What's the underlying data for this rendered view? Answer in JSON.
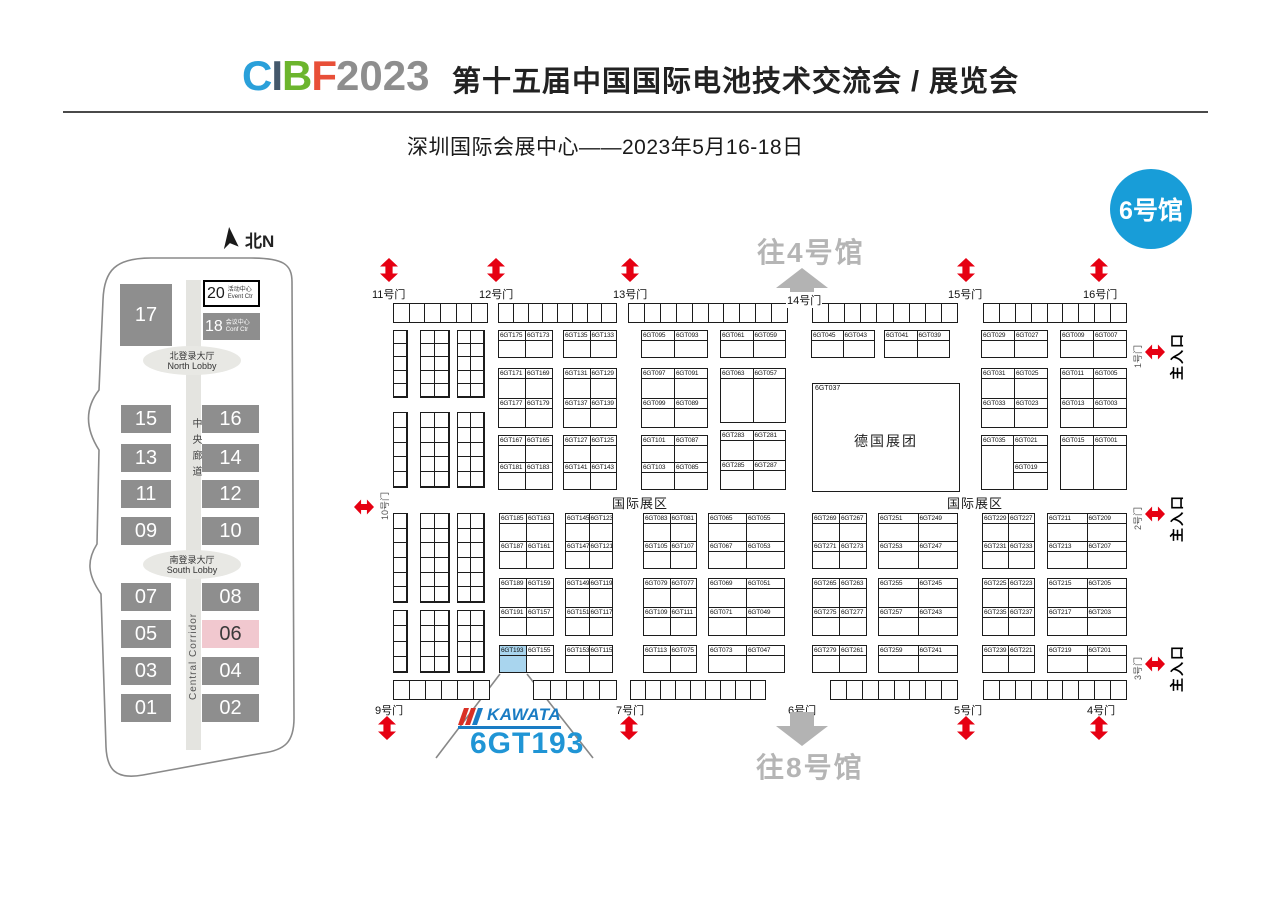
{
  "header": {
    "logo": {
      "letters": [
        {
          "ch": "C",
          "color": "#2aa0da"
        },
        {
          "ch": "I",
          "color": "#44586b"
        },
        {
          "ch": "B",
          "color": "#6cb52d"
        },
        {
          "ch": "F",
          "color": "#e84f38"
        }
      ],
      "year": "2023",
      "year_color": "#8e8e8e"
    },
    "title": "第十五届中国国际电池技术交流会 / 展览会",
    "subtitle": "深圳国际会展中心——2023年5月16-18日"
  },
  "hall_badge": {
    "label": "6号馆",
    "color": "#189dd8"
  },
  "minimap": {
    "north_label": "北N",
    "hall17": "17",
    "hall20": {
      "num": "20",
      "cn": "活动中心",
      "en": "Event Ctr"
    },
    "hall18": {
      "num": "18",
      "cn": "会议中心",
      "en": "Conf Ctr"
    },
    "north_lobby": {
      "cn": "北登录大厅",
      "en": "North Lobby"
    },
    "south_lobby": {
      "cn": "南登录大厅",
      "en": "South Lobby"
    },
    "corridor_cn": "中央廊道",
    "corridor_en": "Central Corridor",
    "rows": [
      [
        "15",
        "16"
      ],
      [
        "13",
        "14"
      ],
      [
        "11",
        "12"
      ],
      [
        "09",
        "10"
      ],
      [
        "07",
        "08"
      ],
      [
        "05",
        "06"
      ],
      [
        "03",
        "04"
      ],
      [
        "01",
        "02"
      ]
    ],
    "row_y": [
      183,
      222,
      258,
      295,
      361,
      398,
      435,
      472
    ],
    "highlighted_hall": "06"
  },
  "map": {
    "to_hall4": "往4号馆",
    "to_hall8": "往8号馆",
    "intl_zone": "国际展区",
    "main_entrance": "主入口",
    "left_gate": "10号门",
    "gate14": "14号门",
    "gate6": "6号门",
    "german_pavilion": {
      "booth": "6GT037",
      "name": "德国展团"
    },
    "kawata_logo": "KAWATA",
    "callout_booth": "6GT193",
    "highlight_booth": "6GT193",
    "gates_top": [
      {
        "label": "11号门",
        "label_x": 371,
        "arrow_x": 379
      },
      {
        "label": "12号门",
        "label_x": 478,
        "arrow_x": 486
      },
      {
        "label": "13号门",
        "label_x": 612,
        "arrow_x": 620
      },
      {
        "label": "15号门",
        "label_x": 947,
        "arrow_x": 956
      },
      {
        "label": "16号门",
        "label_x": 1082,
        "arrow_x": 1089
      }
    ],
    "gates_bottom": [
      {
        "label": "9号门",
        "label_x": 374,
        "arrow_x": 377
      },
      {
        "label": "7号门",
        "label_x": 615,
        "arrow_x": 619
      },
      {
        "label": "5号门",
        "label_x": 953,
        "arrow_x": 956
      },
      {
        "label": "4号门",
        "label_x": 1086,
        "arrow_x": 1089
      }
    ],
    "side_gates": [
      {
        "door": "1号门",
        "y": 336
      },
      {
        "door": "2号门",
        "y": 498
      },
      {
        "door": "3号门",
        "y": 648
      }
    ],
    "strips": [
      {
        "x": 393,
        "y": 303,
        "w": 95,
        "h": 20,
        "cells": 6
      },
      {
        "x": 498,
        "y": 303,
        "w": 119,
        "h": 20,
        "cells": 8
      },
      {
        "x": 628,
        "y": 303,
        "w": 160,
        "h": 20,
        "cells": 10
      },
      {
        "x": 812,
        "y": 303,
        "w": 146,
        "h": 20,
        "cells": 9
      },
      {
        "x": 983,
        "y": 303,
        "w": 144,
        "h": 20,
        "cells": 9
      },
      {
        "x": 393,
        "y": 680,
        "w": 97,
        "h": 20,
        "cells": 6
      },
      {
        "x": 533,
        "y": 680,
        "w": 84,
        "h": 20,
        "cells": 5
      },
      {
        "x": 630,
        "y": 680,
        "w": 136,
        "h": 20,
        "cells": 9
      },
      {
        "x": 830,
        "y": 680,
        "w": 128,
        "h": 20,
        "cells": 8
      },
      {
        "x": 983,
        "y": 680,
        "w": 144,
        "h": 20,
        "cells": 9
      }
    ],
    "small_groups": [
      {
        "x": 393,
        "y": 330,
        "w": 15,
        "h": 68,
        "cols": 1,
        "rows": 5
      },
      {
        "x": 420,
        "y": 330,
        "w": 30,
        "h": 68,
        "cols": 2,
        "rows": 5
      },
      {
        "x": 457,
        "y": 330,
        "w": 28,
        "h": 68,
        "cols": 2,
        "rows": 5
      },
      {
        "x": 393,
        "y": 412,
        "w": 15,
        "h": 76,
        "cols": 1,
        "rows": 5
      },
      {
        "x": 420,
        "y": 412,
        "w": 30,
        "h": 76,
        "cols": 2,
        "rows": 5
      },
      {
        "x": 457,
        "y": 412,
        "w": 28,
        "h": 76,
        "cols": 2,
        "rows": 5
      },
      {
        "x": 393,
        "y": 513,
        "w": 15,
        "h": 90,
        "cols": 1,
        "rows": 6
      },
      {
        "x": 420,
        "y": 513,
        "w": 30,
        "h": 90,
        "cols": 2,
        "rows": 6
      },
      {
        "x": 457,
        "y": 513,
        "w": 28,
        "h": 90,
        "cols": 2,
        "rows": 6
      },
      {
        "x": 393,
        "y": 610,
        "w": 15,
        "h": 63,
        "cols": 1,
        "rows": 4
      },
      {
        "x": 420,
        "y": 610,
        "w": 30,
        "h": 63,
        "cols": 2,
        "rows": 4
      },
      {
        "x": 457,
        "y": 610,
        "w": 28,
        "h": 63,
        "cols": 2,
        "rows": 4
      }
    ],
    "blocks": [
      {
        "x": 498,
        "y": 330,
        "w": 55,
        "h": 28,
        "rows": [
          [
            "6GT175",
            "6GT173"
          ]
        ]
      },
      {
        "x": 563,
        "y": 330,
        "w": 54,
        "h": 28,
        "rows": [
          [
            "6GT135",
            "6GT133"
          ]
        ]
      },
      {
        "x": 641,
        "y": 330,
        "w": 67,
        "h": 28,
        "rows": [
          [
            "6GT095",
            "6GT093"
          ]
        ]
      },
      {
        "x": 720,
        "y": 330,
        "w": 66,
        "h": 28,
        "rows": [
          [
            "6GT061",
            "6GT059"
          ]
        ]
      },
      {
        "x": 811,
        "y": 330,
        "w": 64,
        "h": 28,
        "rows": [
          [
            "6GT045",
            "6GT043"
          ]
        ]
      },
      {
        "x": 884,
        "y": 330,
        "w": 66,
        "h": 28,
        "rows": [
          [
            "6GT041",
            "6GT039"
          ]
        ]
      },
      {
        "x": 981,
        "y": 330,
        "w": 67,
        "h": 28,
        "rows": [
          [
            "6GT029",
            "6GT027"
          ]
        ]
      },
      {
        "x": 1060,
        "y": 330,
        "w": 67,
        "h": 28,
        "rows": [
          [
            "6GT009",
            "6GT007"
          ]
        ]
      },
      {
        "x": 498,
        "y": 368,
        "w": 55,
        "h": 60,
        "rows": [
          [
            "6GT171",
            "6GT169"
          ],
          [
            "6GT177",
            "6GT179"
          ]
        ]
      },
      {
        "x": 563,
        "y": 368,
        "w": 54,
        "h": 60,
        "rows": [
          [
            "6GT131",
            "6GT129"
          ],
          [
            "6GT137",
            "6GT139"
          ]
        ]
      },
      {
        "x": 641,
        "y": 368,
        "w": 67,
        "h": 60,
        "rows": [
          [
            "6GT097",
            "6GT091"
          ],
          [
            "6GT099",
            "6GT089"
          ]
        ]
      },
      {
        "x": 720,
        "y": 368,
        "w": 66,
        "h": 55,
        "rows": [
          [
            "6GT063",
            "6GT057"
          ]
        ]
      },
      {
        "x": 981,
        "y": 368,
        "w": 67,
        "h": 60,
        "rows": [
          [
            "6GT031",
            "6GT025"
          ],
          [
            "6GT033",
            "6GT023"
          ]
        ]
      },
      {
        "x": 1060,
        "y": 368,
        "w": 67,
        "h": 60,
        "rows": [
          [
            "6GT011",
            "6GT005"
          ],
          [
            "6GT013",
            "6GT003"
          ]
        ]
      },
      {
        "x": 498,
        "y": 435,
        "w": 55,
        "h": 55,
        "rows": [
          [
            "6GT167",
            "6GT165"
          ],
          [
            "6GT181",
            "6GT183"
          ]
        ]
      },
      {
        "x": 563,
        "y": 435,
        "w": 54,
        "h": 55,
        "rows": [
          [
            "6GT127",
            "6GT125"
          ],
          [
            "6GT141",
            "6GT143"
          ]
        ]
      },
      {
        "x": 641,
        "y": 435,
        "w": 67,
        "h": 55,
        "rows": [
          [
            "6GT101",
            "6GT087"
          ],
          [
            "6GT103",
            "6GT085"
          ]
        ]
      },
      {
        "x": 720,
        "y": 430,
        "w": 66,
        "h": 60,
        "rows": [
          [
            "6GT283",
            "6GT281"
          ],
          [
            "6GT285",
            "6GT287"
          ]
        ]
      },
      {
        "x": 981,
        "y": 435,
        "w": 33,
        "h": 55,
        "rows": [
          [
            "6GT035"
          ]
        ]
      },
      {
        "x": 1013,
        "y": 435,
        "w": 35,
        "h": 55,
        "rows": [
          [
            "6GT021"
          ],
          [
            "6GT019"
          ]
        ]
      },
      {
        "x": 1060,
        "y": 435,
        "w": 67,
        "h": 55,
        "rows": [
          [
            "6GT015",
            "6GT001"
          ]
        ]
      },
      {
        "x": 499,
        "y": 513,
        "w": 55,
        "h": 56,
        "rows": [
          [
            "6GT185",
            "6GT163"
          ],
          [
            "6GT187",
            "6GT161"
          ]
        ]
      },
      {
        "x": 565,
        "y": 513,
        "w": 48,
        "h": 56,
        "rows": [
          [
            "6GT145",
            "6GT123"
          ],
          [
            "6GT147",
            "6GT121"
          ]
        ]
      },
      {
        "x": 643,
        "y": 513,
        "w": 54,
        "h": 56,
        "rows": [
          [
            "6GT083",
            "6GT081"
          ],
          [
            "6GT105",
            "6GT107"
          ]
        ]
      },
      {
        "x": 708,
        "y": 513,
        "w": 77,
        "h": 56,
        "rows": [
          [
            "6GT065",
            "6GT055"
          ],
          [
            "6GT067",
            "6GT053"
          ]
        ]
      },
      {
        "x": 812,
        "y": 513,
        "w": 55,
        "h": 56,
        "rows": [
          [
            "6GT269",
            "6GT267"
          ],
          [
            "6GT271",
            "6GT273"
          ]
        ]
      },
      {
        "x": 878,
        "y": 513,
        "w": 80,
        "h": 56,
        "rows": [
          [
            "6GT251",
            "6GT249"
          ],
          [
            "6GT253",
            "6GT247"
          ]
        ]
      },
      {
        "x": 982,
        "y": 513,
        "w": 53,
        "h": 56,
        "rows": [
          [
            "6GT229",
            "6GT227"
          ],
          [
            "6GT231",
            "6GT233"
          ]
        ]
      },
      {
        "x": 1047,
        "y": 513,
        "w": 80,
        "h": 56,
        "rows": [
          [
            "6GT211",
            "6GT209"
          ],
          [
            "6GT213",
            "6GT207"
          ]
        ]
      },
      {
        "x": 499,
        "y": 578,
        "w": 55,
        "h": 58,
        "rows": [
          [
            "6GT189",
            "6GT159"
          ],
          [
            "6GT191",
            "6GT157"
          ]
        ]
      },
      {
        "x": 565,
        "y": 578,
        "w": 48,
        "h": 58,
        "rows": [
          [
            "6GT149",
            "6GT119"
          ],
          [
            "6GT151",
            "6GT117"
          ]
        ]
      },
      {
        "x": 643,
        "y": 578,
        "w": 54,
        "h": 58,
        "rows": [
          [
            "6GT079",
            "6GT077"
          ],
          [
            "6GT109",
            "6GT111"
          ]
        ]
      },
      {
        "x": 708,
        "y": 578,
        "w": 77,
        "h": 58,
        "rows": [
          [
            "6GT069",
            "6GT051"
          ],
          [
            "6GT071",
            "6GT049"
          ]
        ]
      },
      {
        "x": 812,
        "y": 578,
        "w": 55,
        "h": 58,
        "rows": [
          [
            "6GT265",
            "6GT263"
          ],
          [
            "6GT275",
            "6GT277"
          ]
        ]
      },
      {
        "x": 878,
        "y": 578,
        "w": 80,
        "h": 58,
        "rows": [
          [
            "6GT255",
            "6GT245"
          ],
          [
            "6GT257",
            "6GT243"
          ]
        ]
      },
      {
        "x": 982,
        "y": 578,
        "w": 53,
        "h": 58,
        "rows": [
          [
            "6GT225",
            "6GT223"
          ],
          [
            "6GT235",
            "6GT237"
          ]
        ]
      },
      {
        "x": 1047,
        "y": 578,
        "w": 80,
        "h": 58,
        "rows": [
          [
            "6GT215",
            "6GT205"
          ],
          [
            "6GT217",
            "6GT203"
          ]
        ]
      },
      {
        "x": 499,
        "y": 645,
        "w": 55,
        "h": 28,
        "rows": [
          [
            "6GT193",
            "6GT155"
          ]
        ]
      },
      {
        "x": 565,
        "y": 645,
        "w": 48,
        "h": 28,
        "rows": [
          [
            "6GT153",
            "6GT115"
          ]
        ]
      },
      {
        "x": 643,
        "y": 645,
        "w": 54,
        "h": 28,
        "rows": [
          [
            "6GT113",
            "6GT075"
          ]
        ]
      },
      {
        "x": 708,
        "y": 645,
        "w": 77,
        "h": 28,
        "rows": [
          [
            "6GT073",
            "6GT047"
          ]
        ]
      },
      {
        "x": 812,
        "y": 645,
        "w": 55,
        "h": 28,
        "rows": [
          [
            "6GT279",
            "6GT261"
          ]
        ]
      },
      {
        "x": 878,
        "y": 645,
        "w": 80,
        "h": 28,
        "rows": [
          [
            "6GT259",
            "6GT241"
          ]
        ]
      },
      {
        "x": 982,
        "y": 645,
        "w": 53,
        "h": 28,
        "rows": [
          [
            "6GT239",
            "6GT221"
          ]
        ]
      },
      {
        "x": 1047,
        "y": 645,
        "w": 80,
        "h": 28,
        "rows": [
          [
            "6GT219",
            "6GT201"
          ]
        ]
      }
    ],
    "colors": {
      "red_arrow": "#e60012",
      "gray_arrow": "#b3b3b3",
      "highlight_fill": "#a9d5ee",
      "kawata_blue": "#1a7cc4",
      "callout_blue": "#2095d5"
    }
  }
}
